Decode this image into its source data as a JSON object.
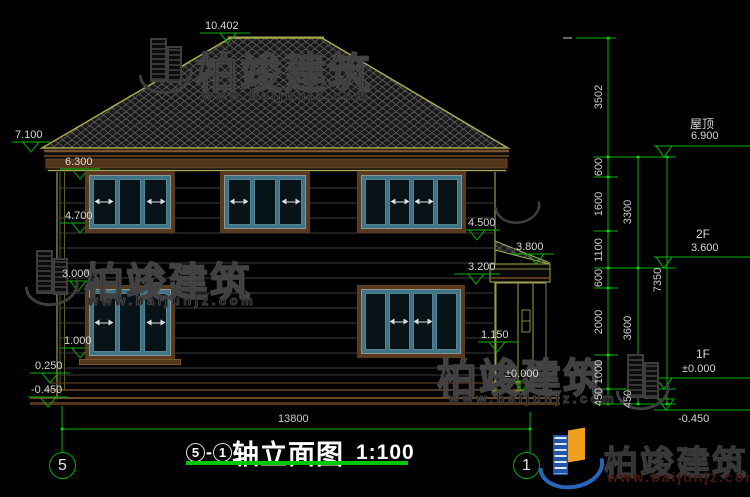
{
  "drawing": {
    "title": {
      "axis_left": "5",
      "separator": "-",
      "axis_right": "1",
      "name": "轴立面图",
      "scale": "1:100"
    },
    "axes": {
      "left": "5",
      "right": "1"
    }
  },
  "levels_left": {
    "ridge": "10.402",
    "eave": "7.100",
    "f2_head": "6.300",
    "f2_sill": "4.700",
    "f1_head": "3.000",
    "f1_sill": "1.000",
    "plinth": "0.250",
    "ground": "-0.450"
  },
  "levels_porch": {
    "roof_top": "4.500",
    "roof_edge": "3.800",
    "beam": "3.200",
    "sill": "1.150",
    "floor": "±0.000"
  },
  "levels_right": {
    "roof_label": "屋顶",
    "roof": "6.900",
    "f2_label": "2F",
    "f2": "3.600",
    "f1_label": "1F",
    "f1": "±0.000",
    "ground": "-0.450"
  },
  "dims": {
    "overall_width": "13800",
    "roof_rise": "3502",
    "chain_segments": [
      "600",
      "1600",
      "1100",
      "600",
      "2000",
      "1000",
      "450"
    ],
    "chain_floors": [
      "3300",
      "3600",
      "450"
    ],
    "total_height": "7350"
  },
  "watermark": {
    "brand": "柏竣建筑",
    "url": "www.baijunjz.com"
  },
  "logo": {
    "brand": "柏竣建筑",
    "url": "www.baijunjz.com"
  },
  "colors": {
    "dim_green": "#00b400",
    "outline_olive": "#9c9c4e",
    "trim_brown": "#6e4a28",
    "logo_blue": "#2257a8",
    "logo_orange": "#f09f1e"
  }
}
